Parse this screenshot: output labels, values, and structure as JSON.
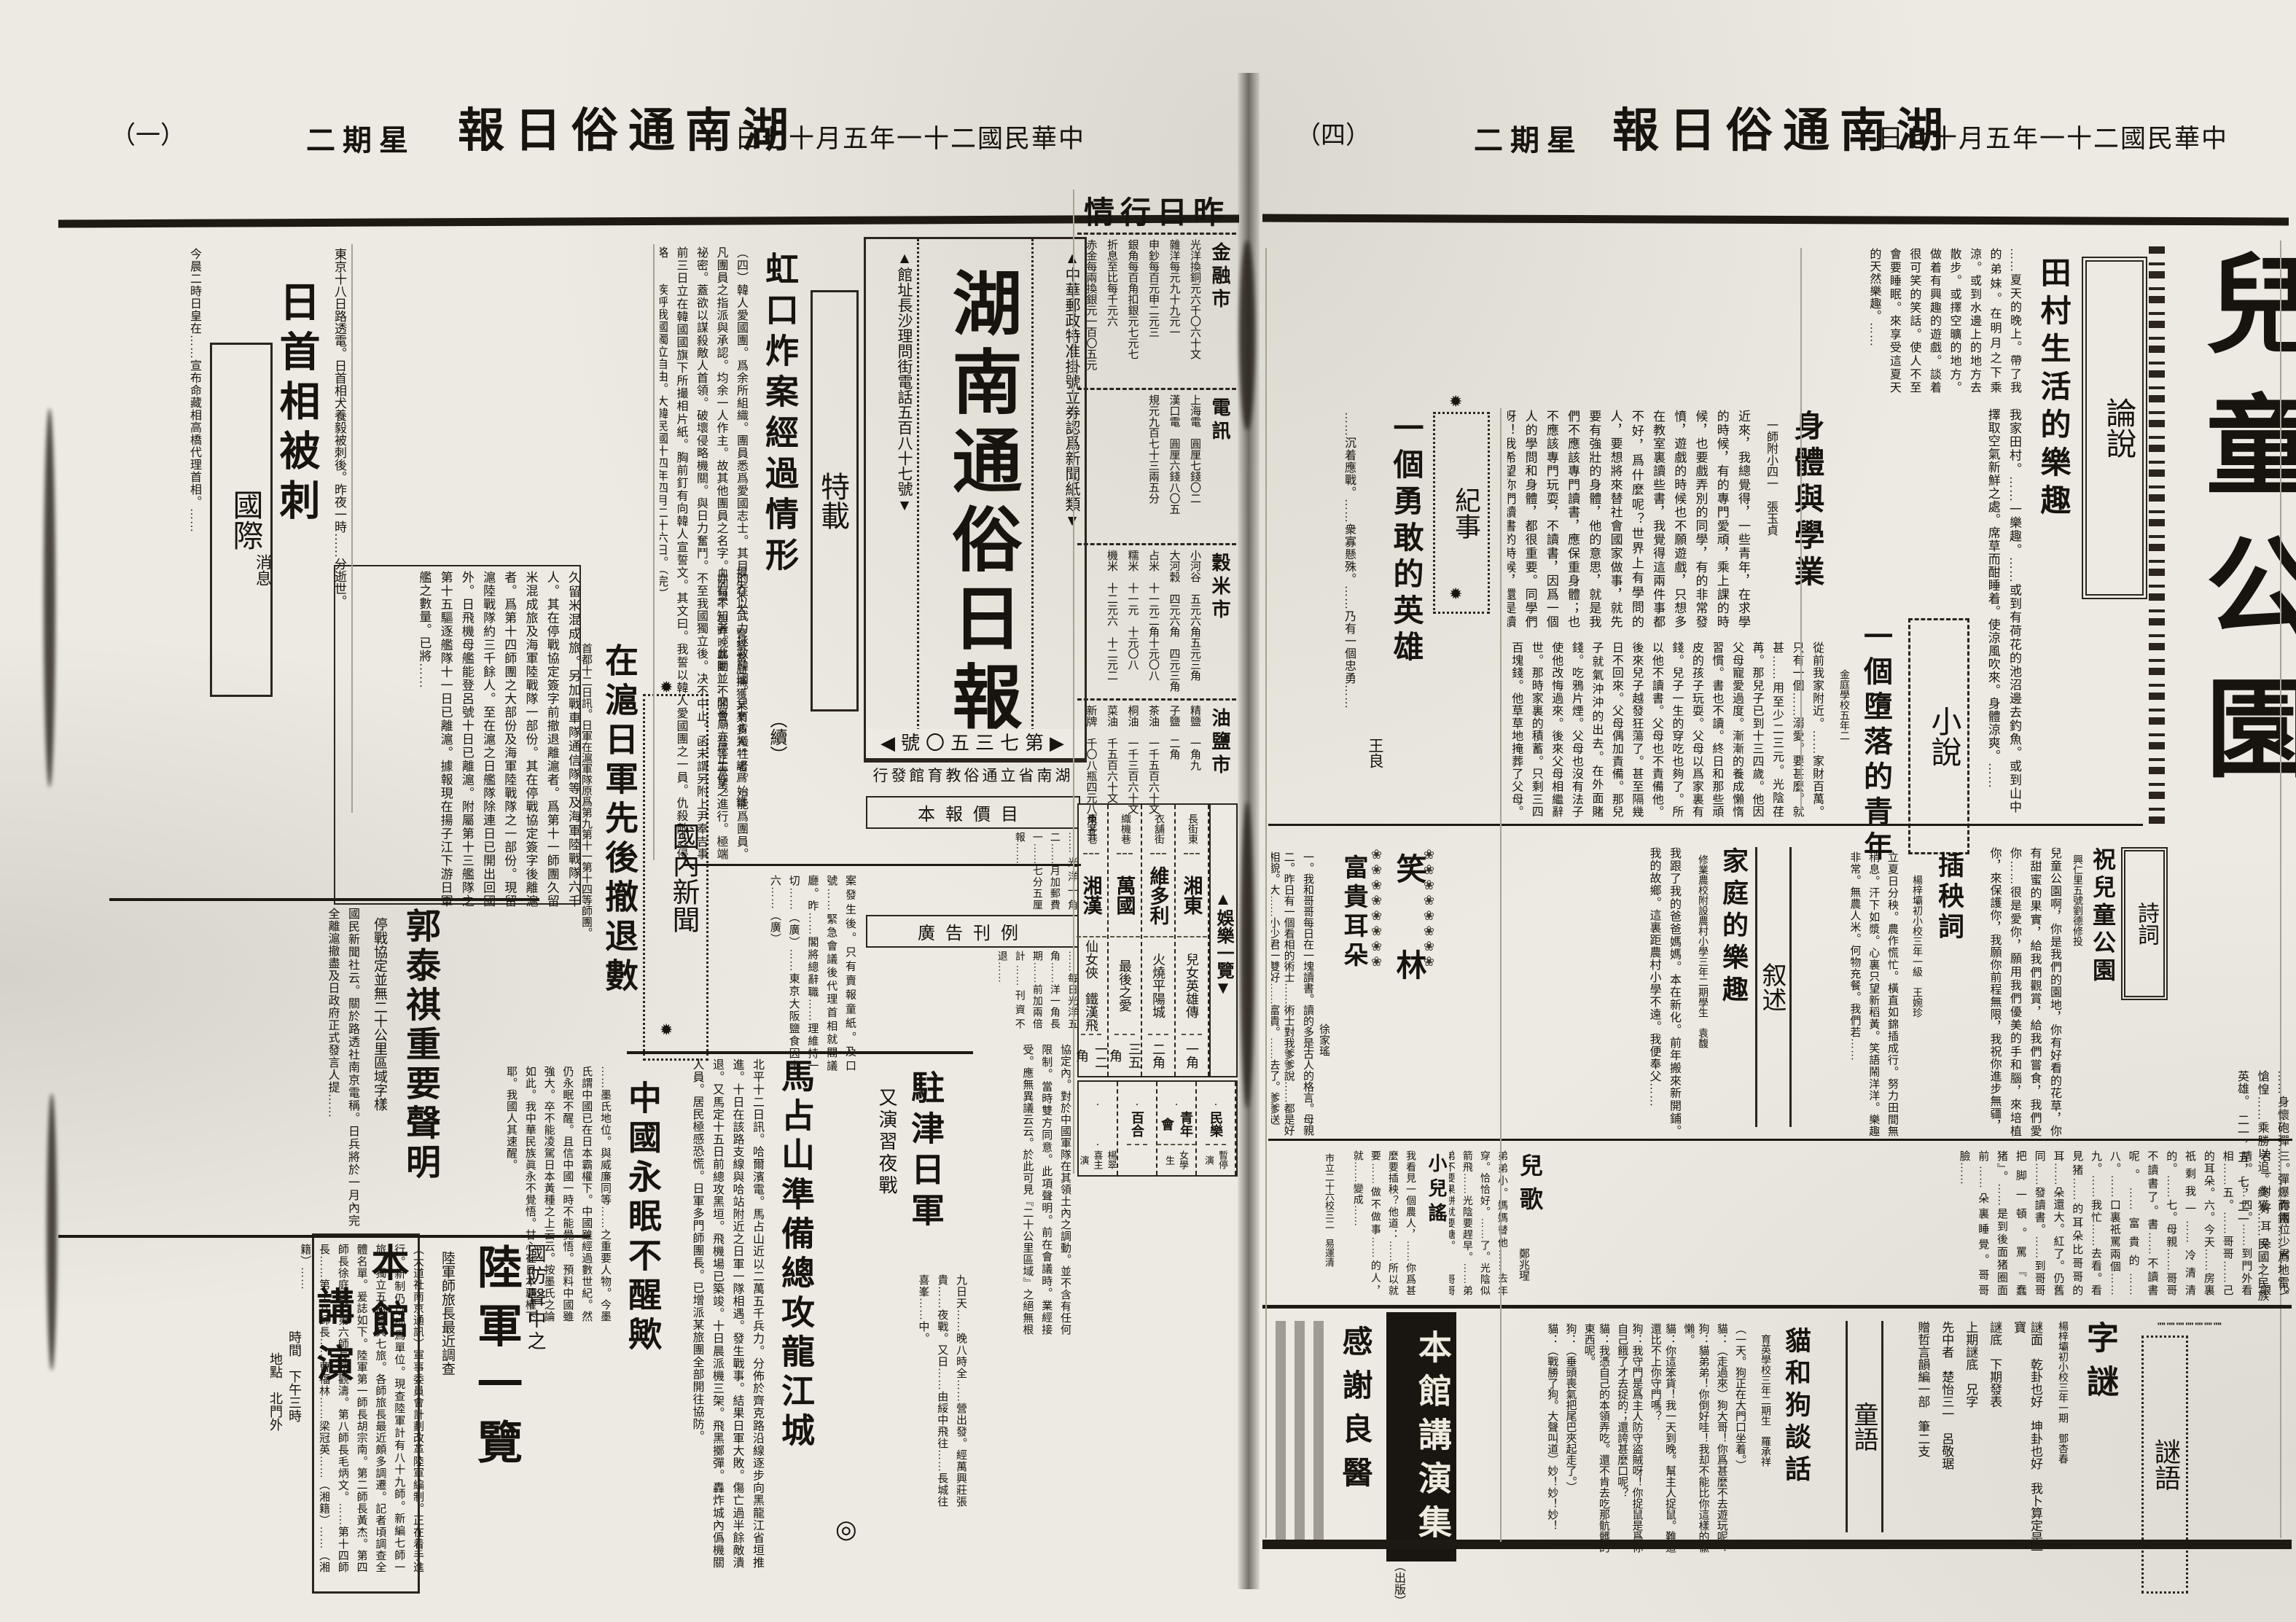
{
  "ornaments": {
    "gear": "✹",
    "flower_col": "❀❀❀❀❀❀❀❀",
    "circle": "◎",
    "dot_line": "┉┉┉┉┉┉┉"
  },
  "left_header": {
    "page_no": "（一）",
    "weekday": "二期星",
    "title": "報日俗通南湖",
    "date": "日七十月五年一十二國民華中"
  },
  "right_header": {
    "page_no": "（四）",
    "weekday": "二期星",
    "title": "報日俗通南湖",
    "date": "日七十月五年一十二國民華中"
  },
  "masthead": {
    "title": "湖南通俗日報",
    "postal": "▲中華郵政特准掛號立券認爲新聞紙類▼",
    "address": "▲館址長沙理問街電話五百八十七號▼",
    "issue": "◀號〇五三七第▶",
    "publisher": "行發館育教俗通立省南湖"
  },
  "tezai": {
    "section": "特載",
    "title": "虹口炸案經過情形",
    "cont": "（續）",
    "body": "（四）韓人愛國團。爲余所組織。團員悉爲愛國志士。其目的在以武力拯救韓國。只有肯犧牲者。始能爲團員。凡團員之指派與承認。均余一人作主。故其他團員之名字。亦有不知者。此團並不開會。吾等工作之進行。極端祕密。蓋欲以謀殺敵人首領。破壞侵略機關。與日力奮鬥。不至我國獨立後。决不中止。函末謂另附上尹奉吉事前三日立在韓國國旗下所撮相片紙。胸前釘有向韓人宣誓文。其文曰。我誓以韓人愛國團之一員。仇殺敵之侵略……疾呼我國獨立自由。大韓民國十四年四月二十六日。（完）",
    "after": "案發生後。只有賣報童紙。及口號……緊急會議後代理首相就閣議廳。昨……閣將總辭職……理維持一切……（廣）……東京大阪鹽食因十六……（廣）"
  },
  "intl": {
    "section": "國際",
    "title": "日首相被刺",
    "sub": "消息",
    "lead": "東京十八日路透電。日首相犬養毅被刺後。昨夜一時……分逝世。",
    "body": "今晨二時日皇在……宣布命藏相高橋代理首相。……"
  },
  "domestic_label": "國內新聞",
  "shanghai": {
    "title": "在滬日軍先後撤退數",
    "lead": "首都十二日訊。日軍在滬軍隊原爲第九第十一第十四等師團。",
    "body": "久留米混成旅。另加戰車隊通信隊等及海軍陸戰隊六千人。其在停戰協定簽字前撤退離滬者。爲第十一師團久留米混成旅及海軍陸戰隊一部份。其在停戰協定簽字後離滬者。爲第十四師團之大部份及海軍陸戰隊之一部份。現留滬陸戰隊約三千餘人。至在滬之日艦隊除連日已開出回國外。日飛機母艦能登呂號十日已離滬。附屬第十三艦隊之第十五驅逐艦隊十一日已離滬。據報現在揚子江下游日軍艦之數量。已將……",
    "side": "損失不大。警察當局捕獲某某多人。認爲『鐵血同盟』與昨晚暴動……交易廟亦停止營業。"
  },
  "sleep": {
    "title": "中國永眠不醒歟",
    "body": "……墨氏地位。與威廉同等……之重要人物。今墨氏謂中國已在日本霸權下。中國雖經過數世紀。然仍永眠不醒。且信中國一時不能覺悟。預料中國雖強大。卒不能凌駕日本黃種之上云云。按墨氏之論如此。我中華民族眞永不覺悟。甘心在日本覇權下耶。我國人其速醒。"
  },
  "guo": {
    "title": "郭泰祺重要聲明",
    "sub": "停戰協定並無二十公里區域字樣",
    "body": "國民新聞社云。關於路透社南京電稱。日兵將於一月內完全離滬撤盡及日政府正式發言人提……",
    "body2": "協定內。對於中國軍隊在其領土內之調動。並不含有任何限制。當時雙方同意。此項聲明。前在會議時。業經接受。應無異議云云。於此可見『二十公里區域』之絕無根據矣。"
  },
  "army": {
    "kicker": "國防聲中之",
    "title": "陸軍一覽",
    "sub": "陸軍師旅長最近調查",
    "body": "（大道社南京通訊）軍事委員會計劃改革陸軍編制。正在着手進行。新制仍以師爲單位。現查陸軍計有八十九師。新編七師一旅。獨立五旅騎兵七旅。各師旅長最近頗多調遷。記者頃調查全體名單。爰誌如下。陸軍第一師長胡宗南。第二師長黃杰。第四師長徐庭瑤。第六師長趙觀濤。第八師長毛炳文。……第十四師長……第十八師長……曹福林……梁冠英……（湘籍）……（湘籍）……"
  },
  "ma": {
    "title": "馬占山準備總攻龍江城",
    "body": "北平十二日訊。哈爾濱電。馬占山近以二萬五千兵力。分佈於齊克路沿線逐步向黑龍江省垣推進。十日在該路支線與哈站附近之日軍一隊相遇。發生戰事。結果日軍大敗。傷亡過半餘敵潰退。又馬定十五日前總攻黑垣。飛機場已築竣。十日晨派機三架。飛黑擲彈。轟炸城內僞機關人員。居民極感恐慌。日軍多門師團長。已增派某旅團全部開往協防。"
  },
  "tianjin": {
    "title": "駐津日軍",
    "sub": "又演習夜戰",
    "body": "九日天……晚八時全……營出發。經萬興莊張貴……夜戰。又日……由綏中飛往……長城往喜峯……中。"
  },
  "notices": {
    "price_title": "本報價目",
    "price_body": "……光洋一角二……月加郵費一……七分五厘報……",
    "ad_title": "廣告刊例",
    "ad_body": "……每日光洋五角……洋一角長期……前加兩倍計……刊資不退……"
  },
  "entertainment": {
    "label": "▲娛樂一覽▼",
    "rows": [
      {
        "street": "長街東",
        "hall": "湘東",
        "show": "兒女英雄傳",
        "price": "一角"
      },
      {
        "street": "衣舖街",
        "hall": "維多利",
        "show": "火燒平陽城",
        "price": "二角"
      },
      {
        "street": "織機巷",
        "hall": "萬國",
        "show": "最後之愛",
        "price": "三五角"
      },
      {
        "street": "東茅巷",
        "hall": "湘漢",
        "show": "仙女俠　鐵漢飛",
        "price": "一二角"
      }
    ],
    "rows2": [
      {
        "street": "",
        "hall": "民樂",
        "show": "暫停演",
        "price": ""
      },
      {
        "street": "",
        "hall": "青年會",
        "show": "女學生",
        "price": ""
      },
      {
        "street": "",
        "hall": "百合",
        "show": "",
        "price": ""
      },
      {
        "street": "",
        "hall": "",
        "show": "楊翠喜主演",
        "price": ""
      }
    ]
  },
  "market": {
    "title": "情行日昨",
    "sections": [
      {
        "label": "金融市",
        "items": [
          "光洋換銅元六千〇六十文",
          "雜洋每元九十九元一",
          "申鈔每百元申二元三",
          "銀角每百角扣銀元七元七",
          "折息至比每千元六",
          "赤金每兩換銀元一百〇五元"
        ]
      },
      {
        "label": "電訊",
        "items": [
          "上海電　圓厘七錢〇二",
          "漢口電　圓厘六錢八〇五",
          "規元九百七十三兩五分"
        ]
      },
      {
        "label": "穀米市",
        "items": [
          "小河谷　五元六角五元三角",
          "大河穀　四元六角　四元三角",
          "占米　十一元二角十元〇八",
          "糯米　十一元　十元〇八",
          "機米　十二元六　十二元二"
        ]
      },
      {
        "label": "油鹽市",
        "items": [
          "精鹽　一角九",
          "子鹽　二角",
          "茶油　一千五百六十文",
          "桐油　一千三百六十文",
          "菜油　千五百六十文",
          "新牌　千〇八瓶四元八角五",
          "老牌　千一百六瓶四元九五"
        ]
      }
    ]
  },
  "lecture": {
    "title_a": "本館",
    "title_b": "講演",
    "line1": "時間　下午三時",
    "line2": "地點　北門外"
  },
  "page_title": "兒童公園",
  "editorial": {
    "section": "論說",
    "title": "田村生活的樂趣",
    "body_a": "……夏天的晚上。帶了我的弟妹。在明月之下乘涼。或到水邊上的地方去散步。或擇空曠的地方。做着有興趣的遊戲。談着很可笑的笑話。使人不至會要睡眠。來享受這夏天的天然樂趣。……",
    "body_b": "我家田村。……一樂趣。……或到有荷花的池沼邊去釣魚。或到山中擇取空氣新鮮之處。席草而酣睡着。使涼風吹來。身體涼爽。……"
  },
  "record": {
    "section": "紀事",
    "title": "一個勇敢的英雄",
    "author": "王良",
    "body": "……沉着應戰。……衆寡懸殊。……乃有一個忠勇……",
    "cont": "……身懷砲彈……彈爆而鐵……爲地雷。愴惶……乘勝以追。終獲……民國之民族英雄。　二一，五，七，二一"
  },
  "essay2": {
    "title": "身體與學業",
    "author": "一師附小四一　張玉貞",
    "body": "近來，我總覺得，一些青年，在求學的時候，有的專門愛頑，乘上課的時候，也要戲弄別的同學，有的非常發憤，遊戲的時候也不願遊戲，只想多在教室裏讀些書，我覺得這兩件事都不好，爲什麼呢？世界上有學問的人，要想將來替社會國家做事，就先要有強壯的身體，他的意思，就是我們不應該專門讀書，應保重身體；也不應該專門玩耍，不讀書，因爲一個人的學問和身體，都很重要。同學們呀！我希望你們讀書的時候，還是讀書；運動的時候，便要多多的運動，休息的時候，也要靜心休息，如是我們有學問和強健的身體，將來才能挽救，這危難的大中華民國。"
  },
  "novel": {
    "section": "小說",
    "title": "一個墮落的青年",
    "author": "金庭學校五年二",
    "body": "從前我家附近。……家財百萬。只有一個……溺愛。要甚麼。就甚……用至少二三元。光陰荏苒。那兒子已到十三四歲。他因父母寵愛過度。漸漸的養成懶惰習慣。書也不讀。終日和那些頑皮的孩子玩耍。父母以爲家裏有錢。兒子一生的穿吃也夠了。所以他不讀書。父母也不責備他。後來兒子越發狂蕩了。甚至隔幾日不回來。父母偶加責備。那兒子就氣沖沖的出去。在外面賭錢。吃鴉片煙。父母也沒有法子使他改悔過來。後來父母相繼辭世。那時家裏的積蓄。只剩三四百塊錢。他草草地掩葬了父母。仍不改性。依舊和那些流……混在一處……爲生。甚至還要……才後悔過去……"
  },
  "poem_insert": {
    "title": "插秧詞",
    "author": "楊梓壩初小校三年一級　王婉珍",
    "body": "立夏日分秧。農作慌忙。橫直如錦插成行。努力田間無稍息。汗下如漿。心裏只望新稻黃。笑語鬧洋洋。樂趣非常。無農人米。何物充餐。我們若……"
  },
  "poem_park": {
    "section": "詩詞",
    "title": "祝兒童公園",
    "byline": "興仁里五號劉德修投",
    "body": "兒童公園啊，你是我們的園地，你有好看的花草，你有甜蜜的果實，給我們觀賞，給我們嘗食，我們愛你……很是愛你，願用我們優美的手和腦，來培植你，來保護你，我願你前程無限，我祝你進步無疆，"
  },
  "narrative": {
    "section": "叙述",
    "title": "家庭的樂趣",
    "author": "修業農校附設農村小學三年二期學生　袁馥",
    "body": "我跟了我的爸爸媽媽。本在新化。前年搬來新開鋪。我的故鄉。這裏距農村小學不遠。我便奉父……"
  },
  "xiaolin": {
    "section": "笑林",
    "title": "富貴耳朵",
    "author": "徐家瑤",
    "items": [
      "一。我和哥哥每日在一塊讀書。讀的多是古人的格言。母親買得有糖果。誰的書先讀熟了。就有糖果吃。",
      "二。昨日有一個看相的術士……術士對我爹爹說……都是好相貌。大……小少君一雙好……富貴。……去了。爹爹送他……了鏡子。照他自……"
    ],
    "cont": "三。……你兩位少君……少君一對好耳朵……眼睛。……四。……到門外看相……五。……哥哥……己的耳朵。六。今天……房裏祇剩我一……冷清清的。……七。母親……哥哥不讀書了。書……不讀書呢。……富貴的……八。……口裏祇罵兩個……九。……我忙……去看。看見猪……的耳朵比哥哥的耳……朵還大。紅了。仍舊同……發讀書。……到哥哥把脚一頓。罵『蠢猪』。……是到後面猪圈面前……朵裏睡覺。哥哥臉……"
  },
  "erge": {
    "title": "兒歌",
    "author": "鄭兆瑆",
    "body": "弟弟小。媽媽替他……去年穿。恰恰好。……了。光陰似箭飛……光陰要趕早。……弟弟不要果餅就要糖。……哥哥大。進學堂。功課忙。天光忙到……造成好脚色。……報答父母恩和德。"
  },
  "yao": {
    "title": "小兒謠",
    "author": "市立二十六校三二　易運清",
    "body": "我看見一個農人，……你爲甚麼要插秧？他道：……所以就要……做不做事……的人，就……變成……"
  },
  "zimi": {
    "title": "字謎",
    "school": "楊梓壩初小校三年一期　鄧杏春",
    "lines": [
      "謎面　乾卦也好　坤卦也好　我卜算定是一寶",
      "謎底　下期發表",
      "上期謎底　兄字",
      "先中者　楚怡三一　呂敬琚",
      "贈哲言韻編一部　筆二支"
    ]
  },
  "miyu_label": "謎語",
  "tongyu_label": "童語",
  "dialogue": {
    "title": "貓和狗談話",
    "author": "育英學校三年二期生　羅承祥",
    "lines": [
      "（一天。狗正在大門口坐着。）",
      "貓：（走過來）狗大哥！你爲甚麼不去遊玩呢？",
      "狗：貓弟弟！你倒好哇！我却不能比你這樣的偸懶。",
      "貓：你這笨貨！我一天到晚。幫主人捉鼠。難道還比不上你守門嗎？",
      "狗：我守門是爲主人防守盜賊呀！你捉鼠是爲你自己餓了才去捉的；還誇甚麼口呢？",
      "貓：我憑自己的本領弄吃。還不肯去吃那骯髒的東西呢。",
      "狗：（垂頭喪氣把尾巴夾起走了。）",
      "貓：（戰勝了狗。大聲叫道）妙！妙！妙！"
    ]
  },
  "lecture_ad": {
    "text": "本館講演集",
    "pub": "（出版）"
  },
  "thanks_title": "感謝良醫"
}
